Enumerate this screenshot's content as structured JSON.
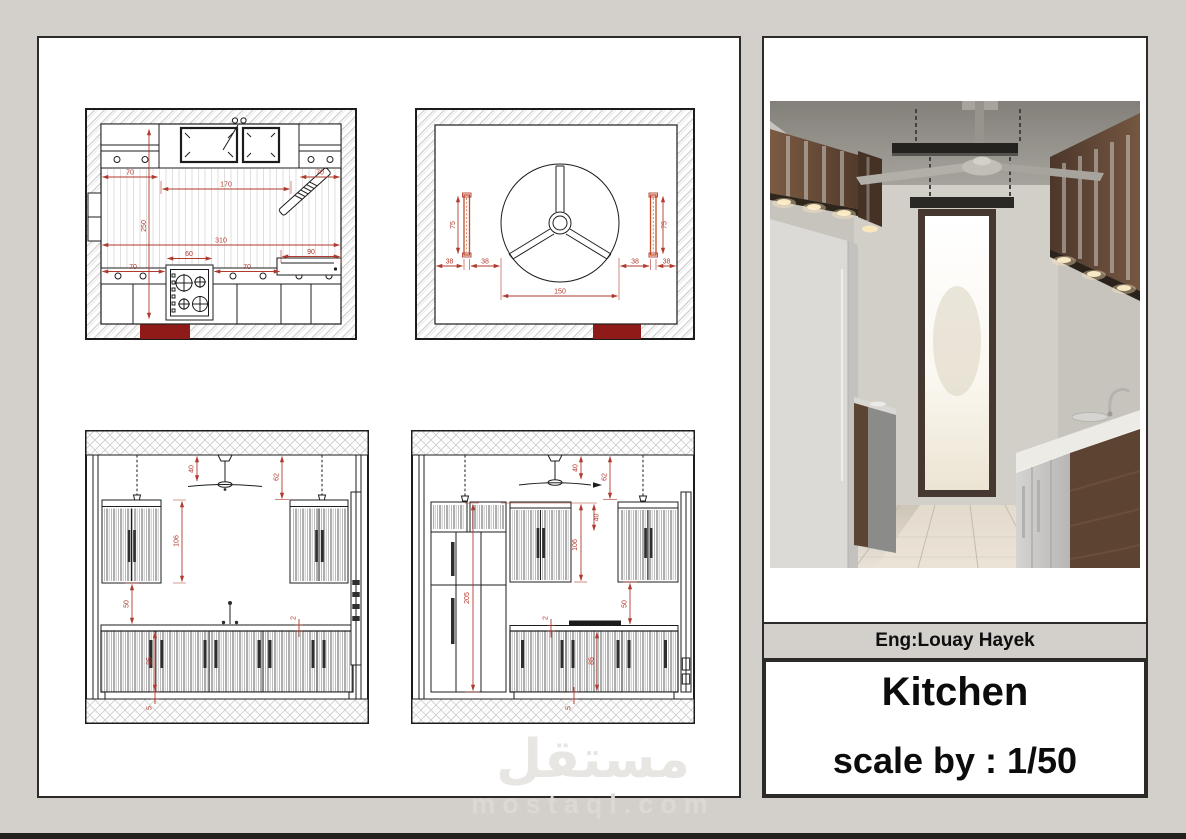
{
  "colors": {
    "canvas_bg": "#d3d0cc",
    "sheet_bg": "#ffffff",
    "line_black": "#1c1c1c",
    "dimension_red": "#b03a2e",
    "mat_dark_red": "#8e1b17",
    "light_fixture_orange": "#c44d27",
    "watermark_gray": "#e8e6e2"
  },
  "title_block": {
    "engineer": "Eng:Louay Hayek",
    "project": "Kitchen",
    "scale": "scale by : 1/50"
  },
  "watermark": {
    "arabic": "مستقل",
    "domain": "mostaql.com"
  },
  "drawings": {
    "floor_plan": {
      "dims": {
        "cab_left": "70",
        "cab_right": "70",
        "sink_run": "170",
        "depth": "250",
        "length": "310",
        "base_left": "70",
        "stove": "60",
        "base_mid": "70",
        "oven_unit": "90"
      }
    },
    "ceiling_plan": {
      "dims": {
        "light_left": "75",
        "light_right": "75",
        "off_a": "38",
        "off_b": "38",
        "off_c": "38",
        "off_d": "38",
        "fan": "150"
      }
    },
    "elevation_a": {
      "dims": {
        "fan_drop": "40",
        "light_drop": "62",
        "wall_cab": "106",
        "splash": "50",
        "base": "85",
        "counter": "2",
        "plinth": "5"
      }
    },
    "elevation_b": {
      "dims": {
        "fan_drop": "40",
        "light_drop": "62",
        "top_box": "40",
        "wall_cab": "106",
        "tall_unit": "205",
        "splash": "50",
        "counter": "2",
        "base": "85",
        "plinth": "5"
      }
    }
  }
}
